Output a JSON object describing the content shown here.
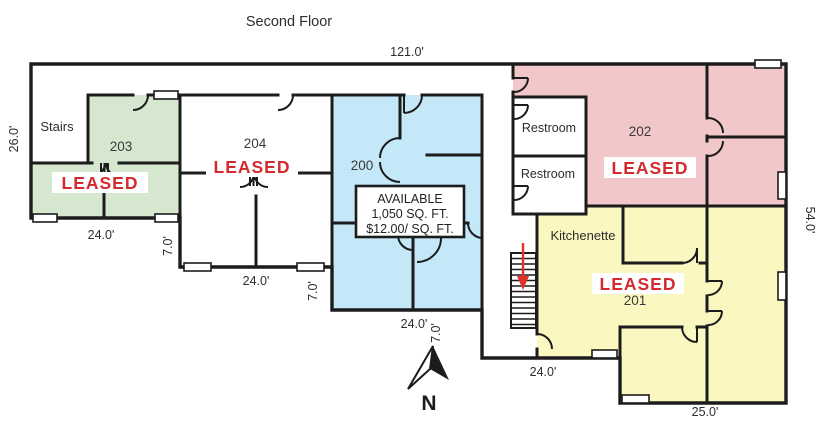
{
  "title": "Second Floor",
  "compass_label": "N",
  "colors": {
    "wall": "#1c1c1c",
    "leased_red": "#d32b2f",
    "arrow_red": "#e23128",
    "room_green": "#d5e8cf",
    "room_blue": "#c5e8f8",
    "room_pink": "#f2c7c9",
    "room_yellow": "#fbf7c0",
    "label_text": "#2e2e2e"
  },
  "rooms": {
    "r203": {
      "number": "203",
      "status": "LEASED"
    },
    "r204": {
      "number": "204",
      "status": "LEASED"
    },
    "r200": {
      "number": "200"
    },
    "r202": {
      "number": "202",
      "status": "LEASED"
    },
    "r201": {
      "number": "201",
      "status": "LEASED"
    }
  },
  "areas": {
    "stairs": "Stairs",
    "restroom_top": "Restroom",
    "restroom_bottom": "Restroom",
    "kitchenette": "Kitchenette"
  },
  "availability_sign": {
    "line1": "AVAILABLE",
    "line2": "1,050 SQ. FT.",
    "line3": "$12.00/ SQ. FT."
  },
  "dimensions": {
    "top_width": "121.0'",
    "left_height": "26.0'",
    "right_height": "54.0'",
    "suite203_width": "24.0'",
    "suite204_width": "24.0'",
    "suite200_width": "24.0'",
    "hall_width": "24.0'",
    "suite201_width": "25.0'",
    "offset_a": "7.0'",
    "offset_b": "7.0'",
    "offset_c": "7.0'"
  }
}
